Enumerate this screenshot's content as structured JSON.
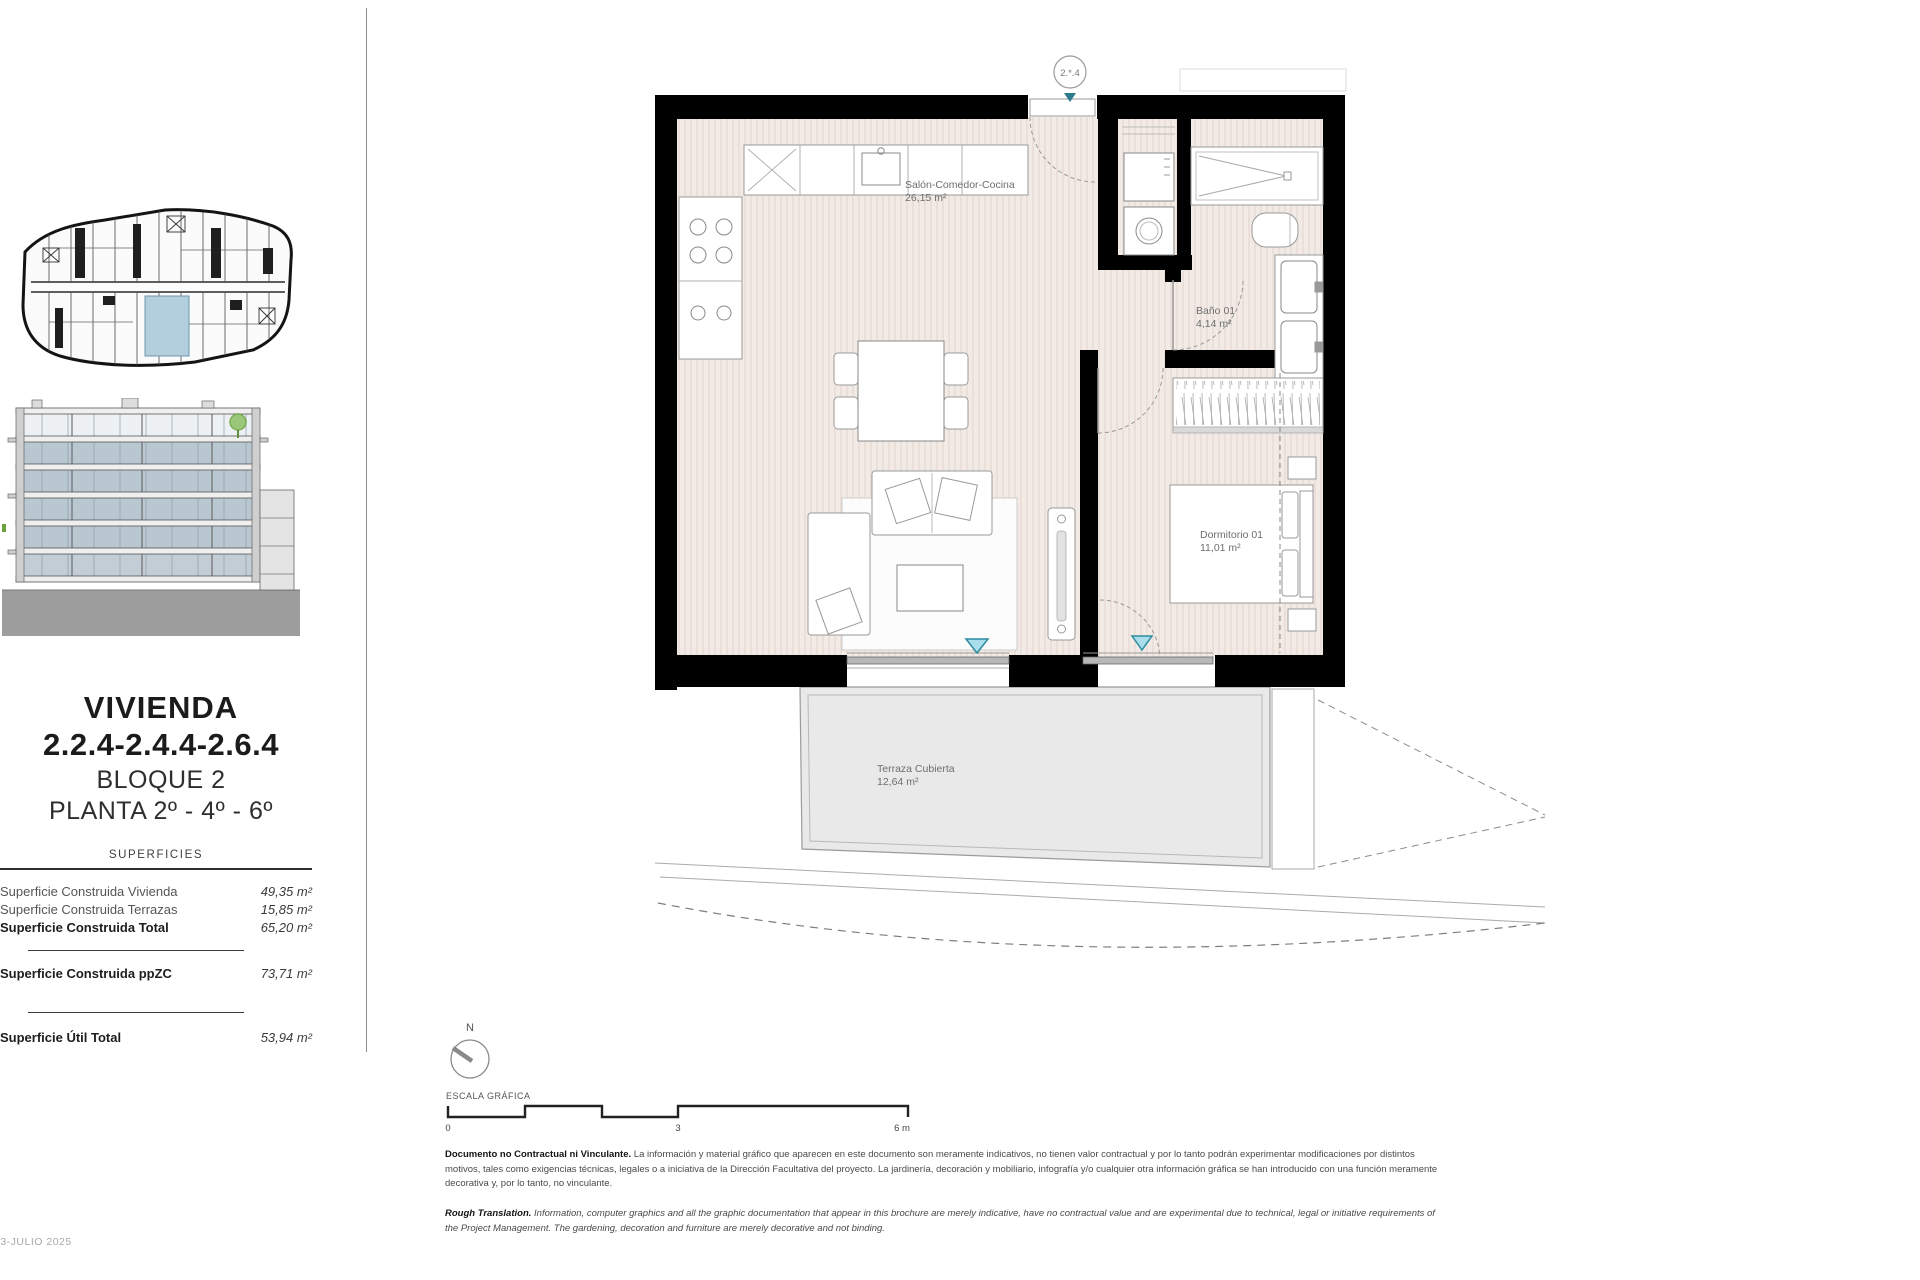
{
  "document": {
    "date": "03-JULIO 2025"
  },
  "sidebar": {
    "title": "VIVIENDA",
    "unit_numbers": "2.2.4-2.4.4-2.6.4",
    "block": "BLOQUE 2",
    "floor": "PLANTA 2º - 4º - 6º",
    "table_title": "SUPERFICIES",
    "rows": [
      {
        "label": "Superficie Construida Vivienda",
        "value": "49,35 m²"
      },
      {
        "label": "Superficie Construida Terrazas",
        "value": "15,85 m²"
      },
      {
        "label": "Superficie Construida Total",
        "value": "65,20 m²"
      },
      {
        "label": "Superficie Construida ppZC",
        "value": "73,71 m²"
      },
      {
        "label": "Superficie Útil Total",
        "value": "53,94 m²"
      }
    ]
  },
  "plan": {
    "unit_marker": "2.*.4",
    "rooms": [
      {
        "name": "Salón-Comedor-Cocina",
        "area": "26,15 m²"
      },
      {
        "name": "Baño 01",
        "area": "4,14 m²"
      },
      {
        "name": "Dormitorio 01",
        "area": "11,01 m²"
      },
      {
        "name": "Terraza Cubierta",
        "area": "12,64 m²"
      }
    ]
  },
  "legend": {
    "north": "N",
    "scale_label": "ESCALA GRÁFICA",
    "ticks": [
      "0",
      "3",
      "6 m"
    ]
  },
  "disclaimer": {
    "es_lead": "Documento no Contractual ni Vinculante.",
    "es_text": "La información y material gráfico que aparecen en este documento son meramente indicativos, no tienen valor contractual y por lo tanto podrán experimentar modificaciones por distintos motivos, tales como exigencias técnicas, legales o a iniciativa de la Dirección Facultativa del proyecto. La jardinería, decoración y mobiliario, infografía y/o cualquier otra información gráfica se han introducido con una función meramente decorativa y, por lo tanto, no vinculante.",
    "en_lead": "Rough Translation.",
    "en_text": "Information, computer graphics and all the graphic documentation that appear in this brochure are merely indicative, have no contractual value and are experimental due to technical, legal or initiative requirements of the Project Management. The gardening, decoration and furniture are merely decorative and not binding."
  },
  "colors": {
    "wall": "#000000",
    "floor": "#f2ebe5",
    "terrace": "#e9e9e9",
    "accent_teal": "#7fd1e0",
    "unit_highlight": "#b3cfdd",
    "tree_green": "#6aa33c"
  }
}
